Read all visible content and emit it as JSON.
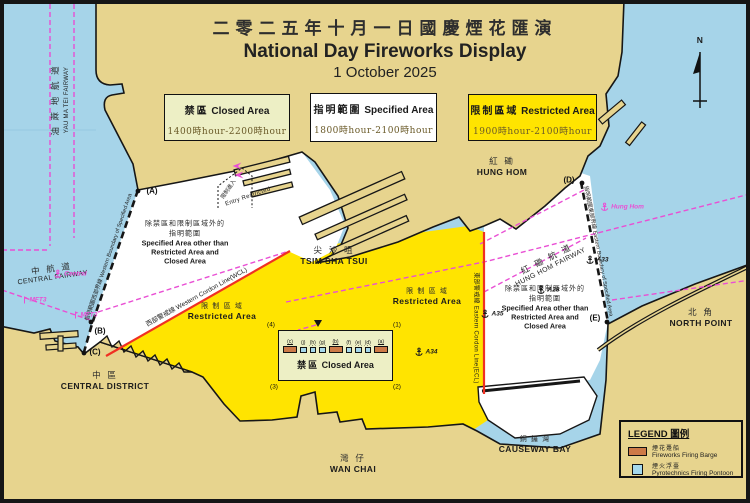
{
  "title": {
    "zh": "二零二五年十月一日國慶煙花匯演",
    "en": "National Day Fireworks Display",
    "date": "1 October 2025"
  },
  "area_boxes": [
    {
      "zh": "禁區",
      "en": "Closed Area",
      "hours": "1400時hour-2200時hour"
    },
    {
      "zh": "指明範圍",
      "en": "Specified Area",
      "hours": "1800時hour-2100時hour"
    },
    {
      "zh": "限制區域",
      "en": "Restricted Area",
      "hours": "1900時hour-2100時hour"
    }
  ],
  "closed_area_box": {
    "zh": "禁區",
    "en": "Closed Area",
    "symbols": [
      {
        "label": "(c)",
        "type": "barge"
      },
      {
        "label": "(j)",
        "type": "pontoon"
      },
      {
        "label": "(h)",
        "type": "pontoon"
      },
      {
        "label": "(g)",
        "type": "pontoon"
      },
      {
        "label": "(b)",
        "type": "barge"
      },
      {
        "label": "(f)",
        "type": "pontoon"
      },
      {
        "label": "(e)",
        "type": "pontoon"
      },
      {
        "label": "(d)",
        "type": "pontoon"
      },
      {
        "label": "(a)",
        "type": "barge"
      }
    ]
  },
  "legend": {
    "title": "LEGEND 圖例",
    "items": [
      {
        "zh": "煙花躉船",
        "en": "Fireworks Firing Barge",
        "type": "barge",
        "color": "#cd7a48"
      },
      {
        "zh": "煙火浮臺",
        "en": "Pyrotechnics Firing Pontoon",
        "type": "pontoon",
        "color": "#a5d8ec"
      }
    ]
  },
  "colors": {
    "water": "#a6d4e9",
    "land": "#e7d48e",
    "restricted_yellow": "#ffe400",
    "closed_pale": "#edefc5",
    "magenta": "#e94fd4",
    "cordon_red": "#f03022",
    "barge_orange": "#cd7a48",
    "pontoon_blue": "#a5d8ec"
  },
  "map_labels": [
    {
      "name": "yau-ma-tei-fairway-zh",
      "x": 55,
      "y": 100,
      "rot": -90,
      "lines": [
        {
          "t": "油 蔴 地 航 道",
          "c": "zh8"
        }
      ]
    },
    {
      "name": "yau-ma-tei-fairway-en",
      "x": 67,
      "y": 100,
      "rot": -90,
      "lines": [
        {
          "t": "YAU MA TEI FAIRWAY",
          "c": "e6"
        }
      ]
    },
    {
      "name": "central-fairway",
      "x": 52,
      "y": 272,
      "rot": -8,
      "lines": [
        {
          "t": "中 航 道",
          "c": "zh8"
        },
        {
          "t": "CENTRAL FAIRWAY",
          "c": "e7"
        }
      ]
    },
    {
      "name": "hung-hom-fairway",
      "x": 548,
      "y": 262,
      "rot": -27,
      "lines": [
        {
          "t": "紅 磡 航 道",
          "c": "zh8"
        },
        {
          "t": "HUNG HOM FAIRWAY",
          "c": "e7"
        }
      ]
    },
    {
      "name": "tsim-sha-tsui",
      "x": 334,
      "y": 255,
      "rot": 0,
      "lines": [
        {
          "t": "尖 沙 咀",
          "c": "zh8"
        },
        {
          "t": "TSIM SHA TSUI",
          "c": "e8b"
        }
      ]
    },
    {
      "name": "hung-hom",
      "x": 502,
      "y": 166,
      "rot": 0,
      "lines": [
        {
          "t": "紅 磡",
          "c": "zh8"
        },
        {
          "t": "HUNG HOM",
          "c": "e8b"
        }
      ]
    },
    {
      "name": "central-district",
      "x": 105,
      "y": 380,
      "rot": 0,
      "lines": [
        {
          "t": "中 區",
          "c": "zh8"
        },
        {
          "t": "CENTRAL DISTRICT",
          "c": "e8b"
        }
      ]
    },
    {
      "name": "wan-chai",
      "x": 353,
      "y": 463,
      "rot": 0,
      "lines": [
        {
          "t": "灣 仔",
          "c": "zh8"
        },
        {
          "t": "WAN CHAI",
          "c": "e8b"
        }
      ]
    },
    {
      "name": "causeway-bay",
      "x": 535,
      "y": 444,
      "rot": 0,
      "lines": [
        {
          "t": "銅 鑼 灣",
          "c": "zh7"
        },
        {
          "t": "CAUSEWAY BAY",
          "c": "e8b"
        }
      ]
    },
    {
      "name": "north-point",
      "x": 701,
      "y": 317,
      "rot": 0,
      "lines": [
        {
          "t": "北 角",
          "c": "zh8"
        },
        {
          "t": "NORTH POINT",
          "c": "e8b"
        }
      ]
    },
    {
      "name": "specified-area-note-west",
      "x": 185,
      "y": 242,
      "rot": 0,
      "lines": [
        {
          "t": "除禁區和限制區域外的",
          "c": "zh7"
        },
        {
          "t": "指明範圍",
          "c": "zh7"
        },
        {
          "t": "Specified Area other than",
          "c": "e7b"
        },
        {
          "t": "Restricted Area and",
          "c": "e7b"
        },
        {
          "t": "Closed Area",
          "c": "e7b"
        }
      ]
    },
    {
      "name": "specified-area-note-east",
      "x": 545,
      "y": 307,
      "rot": 0,
      "lines": [
        {
          "t": "除禁區和限制區域外的",
          "c": "zh7"
        },
        {
          "t": "指明範圍",
          "c": "zh7"
        },
        {
          "t": "Specified Area other than",
          "c": "e7b"
        },
        {
          "t": "Restricted Area and",
          "c": "e7b"
        },
        {
          "t": "Closed Area",
          "c": "e7b"
        }
      ]
    },
    {
      "name": "restricted-area-label-west",
      "x": 222,
      "y": 311,
      "rot": 0,
      "lines": [
        {
          "t": "限 制 區 域",
          "c": "zh7"
        },
        {
          "t": "Restricted Area",
          "c": "e8b"
        }
      ]
    },
    {
      "name": "restricted-area-label-east",
      "x": 427,
      "y": 296,
      "rot": 0,
      "lines": [
        {
          "t": "限 制 區 域",
          "c": "zh7"
        },
        {
          "t": "Restricted Area",
          "c": "e8b"
        }
      ]
    },
    {
      "name": "western-cordon-line-label",
      "x": 196,
      "y": 296,
      "rot": -29,
      "lines": [
        {
          "t": "西部警戒線 Western Cordon Line(WCL)",
          "c": "e65"
        }
      ]
    },
    {
      "name": "eastern-cordon-line-label",
      "x": 477,
      "y": 328,
      "rot": 90,
      "lines": [
        {
          "t": "東部警戒線 Eastern Cordon Line(ECL)",
          "c": "e6"
        }
      ]
    },
    {
      "name": "western-boundary-label",
      "x": 108,
      "y": 257,
      "rot": -71,
      "lines": [
        {
          "t": "指明範圍西部界線 Western Boundary of Specified Area",
          "c": "e55"
        }
      ]
    },
    {
      "name": "eastern-boundary-label",
      "x": 599,
      "y": 251,
      "rot": 79,
      "lines": [
        {
          "t": "指明範圍東部界線 Eastern Boundary of Specified Area",
          "c": "e55"
        }
      ]
    },
    {
      "name": "entry-restricted-zh",
      "x": 228,
      "y": 189,
      "rot": -55,
      "lines": [
        {
          "t": "限制進入",
          "c": "zh55"
        }
      ]
    },
    {
      "name": "entry-restricted-en",
      "x": 248,
      "y": 197,
      "rot": -19,
      "lines": [
        {
          "t": "Entry Restricted",
          "c": "e6"
        }
      ]
    },
    {
      "name": "point-a",
      "x": 152,
      "y": 191,
      "rot": 0,
      "lines": [
        {
          "t": "(A)",
          "c": "pt"
        }
      ]
    },
    {
      "name": "point-b",
      "x": 100,
      "y": 331,
      "rot": 0,
      "lines": [
        {
          "t": "(B)",
          "c": "pt"
        }
      ]
    },
    {
      "name": "point-c",
      "x": 95,
      "y": 352,
      "rot": 0,
      "lines": [
        {
          "t": "(C)",
          "c": "pt"
        }
      ]
    },
    {
      "name": "point-d",
      "x": 569,
      "y": 180,
      "rot": 0,
      "lines": [
        {
          "t": "(D)",
          "c": "pt"
        }
      ]
    },
    {
      "name": "point-e",
      "x": 595,
      "y": 318,
      "rot": 0,
      "lines": [
        {
          "t": "(E)",
          "c": "pt"
        }
      ]
    },
    {
      "name": "corner-1",
      "x": 397,
      "y": 325,
      "rot": 0,
      "lines": [
        {
          "t": "(1)",
          "c": "c6"
        }
      ]
    },
    {
      "name": "corner-2",
      "x": 397,
      "y": 387,
      "rot": 0,
      "lines": [
        {
          "t": "(2)",
          "c": "c6"
        }
      ]
    },
    {
      "name": "corner-3",
      "x": 274,
      "y": 387,
      "rot": 0,
      "lines": [
        {
          "t": "(3)",
          "c": "c6"
        }
      ]
    },
    {
      "name": "corner-4",
      "x": 271,
      "y": 325,
      "rot": 0,
      "lines": [
        {
          "t": "(4)",
          "c": "c6"
        }
      ]
    },
    {
      "name": "north-letter",
      "x": 700,
      "y": 40,
      "rot": 0,
      "lines": [
        {
          "t": "N",
          "c": "e8b"
        }
      ]
    }
  ],
  "markers": [
    {
      "name": "anchorage-central",
      "type": "anchor",
      "color": "mag",
      "label": "Central",
      "x": 70,
      "y": 274
    },
    {
      "name": "anchorage-hung-hom",
      "type": "anchor",
      "color": "mag",
      "label": "Hung Hom",
      "x": 622,
      "y": 207
    },
    {
      "name": "anchorage-a28",
      "type": "anchor",
      "color": "blk",
      "label": "A28",
      "x": 548,
      "y": 290
    },
    {
      "name": "anchorage-a35",
      "type": "anchor",
      "color": "blk",
      "label": "A35",
      "x": 492,
      "y": 314
    },
    {
      "name": "anchorage-a34",
      "type": "anchor",
      "color": "blk",
      "label": "A34",
      "x": 426,
      "y": 352
    },
    {
      "name": "anchorage-a33",
      "type": "anchor",
      "color": "blk",
      "label": "A33",
      "x": 597,
      "y": 260
    },
    {
      "name": "beacon-mft3-west",
      "type": "mast",
      "color": "mag",
      "label": "MFT3",
      "x": 34,
      "y": 300
    },
    {
      "name": "beacon-mft3-east",
      "type": "mast",
      "color": "mag",
      "label": "MFT3",
      "x": 85,
      "y": 315
    },
    {
      "name": "traffic-arrow-1",
      "type": "arrow",
      "color": "mag",
      "label": "",
      "x": 237,
      "y": 166
    },
    {
      "name": "traffic-arrow-2",
      "type": "arrow",
      "color": "mag",
      "label": "",
      "x": 239,
      "y": 175
    }
  ]
}
